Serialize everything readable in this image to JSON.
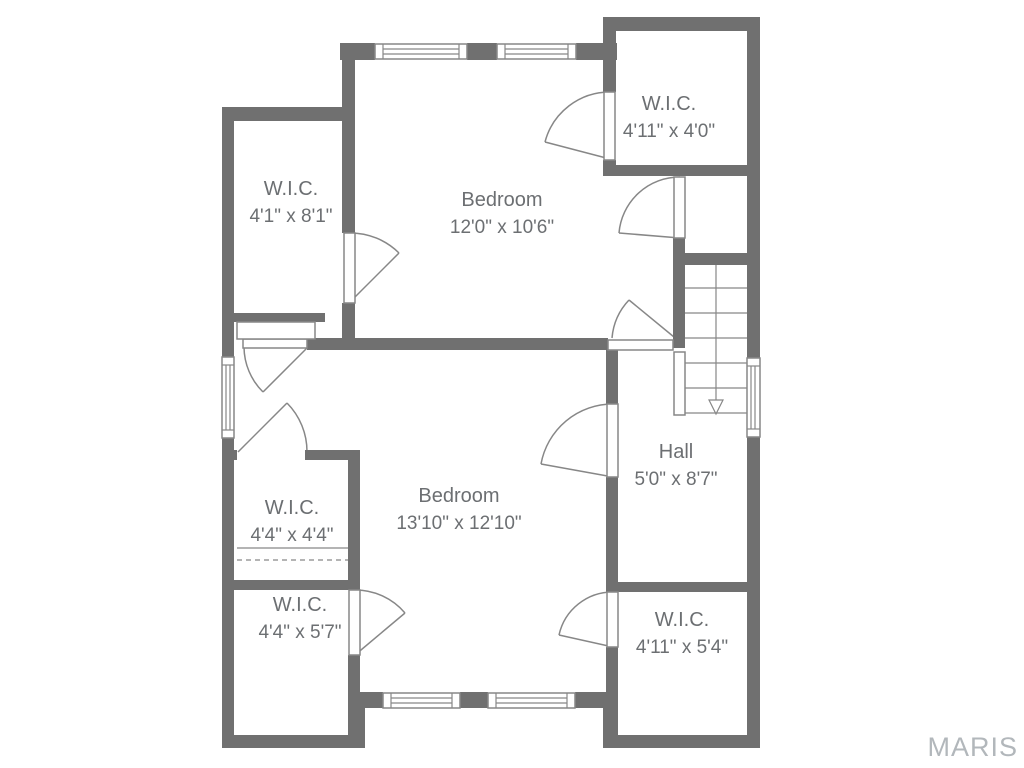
{
  "title": "Second floor plan",
  "watermark": {
    "text": "MARIS"
  },
  "colors": {
    "wall": "#707070",
    "line": "#878787",
    "text": "#6c6f72",
    "watermark": "#b2b7bb",
    "floor": "#ffffff"
  },
  "rooms": {
    "wic_nw": {
      "name": "W.I.C.",
      "dims": "4'1\" x 8'1\""
    },
    "bedroom_n": {
      "name": "Bedroom",
      "dims": "12'0\" x 10'6\""
    },
    "wic_ne": {
      "name": "W.I.C.",
      "dims": "4'11\" x 4'0\""
    },
    "bedroom_s": {
      "name": "Bedroom",
      "dims": "13'10\" x 12'10\""
    },
    "hall": {
      "name": "Hall",
      "dims": "5'0\" x 8'7\""
    },
    "wic_w1": {
      "name": "W.I.C.",
      "dims": "4'4\" x 4'4\""
    },
    "wic_w2": {
      "name": "W.I.C.",
      "dims": "4'4\" x 5'7\""
    },
    "wic_se": {
      "name": "W.I.C.",
      "dims": "4'11\" x 5'4\""
    }
  }
}
